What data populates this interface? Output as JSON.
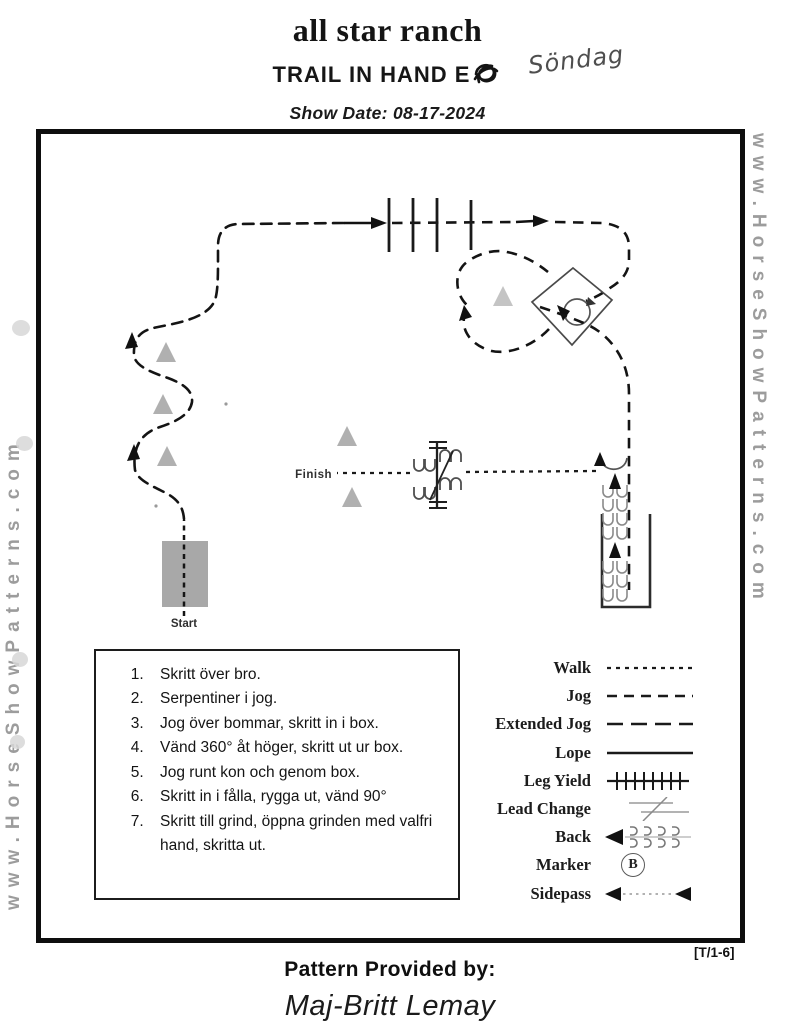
{
  "header": {
    "title": "all star ranch",
    "subtitle": "TRAIL IN HAND E",
    "handwritten_note": "Söndag",
    "show_date": "Show Date: 08-17-2024"
  },
  "watermark": {
    "left": "www.HorseShowPatterns.com",
    "right": "www.HorseShowPatterns.com"
  },
  "diagram": {
    "start_label": "Start",
    "finish_label": "Finish"
  },
  "instructions": {
    "items": [
      "Skritt över bro.",
      "Serpentiner i jog.",
      "Jog över bommar, skritt in i box.",
      "Vänd 360° åt höger, skritt ut ur box.",
      "Jog runt kon och genom box.",
      "Skritt in i fålla, rygga ut, vänd 90°",
      "Skritt till grind, öppna grinden med valfri hand, skritta ut."
    ]
  },
  "legend": {
    "marker_letter": "B",
    "items": [
      "Walk",
      "Jog",
      "Extended Jog",
      "Lope",
      "Leg Yield",
      "Lead Change",
      "Back",
      "Marker",
      "Sidepass"
    ]
  },
  "footer": {
    "reference": "[T/1-6]",
    "provided_by": "Pattern Provided by:",
    "name": "Maj-Britt Lemay"
  }
}
